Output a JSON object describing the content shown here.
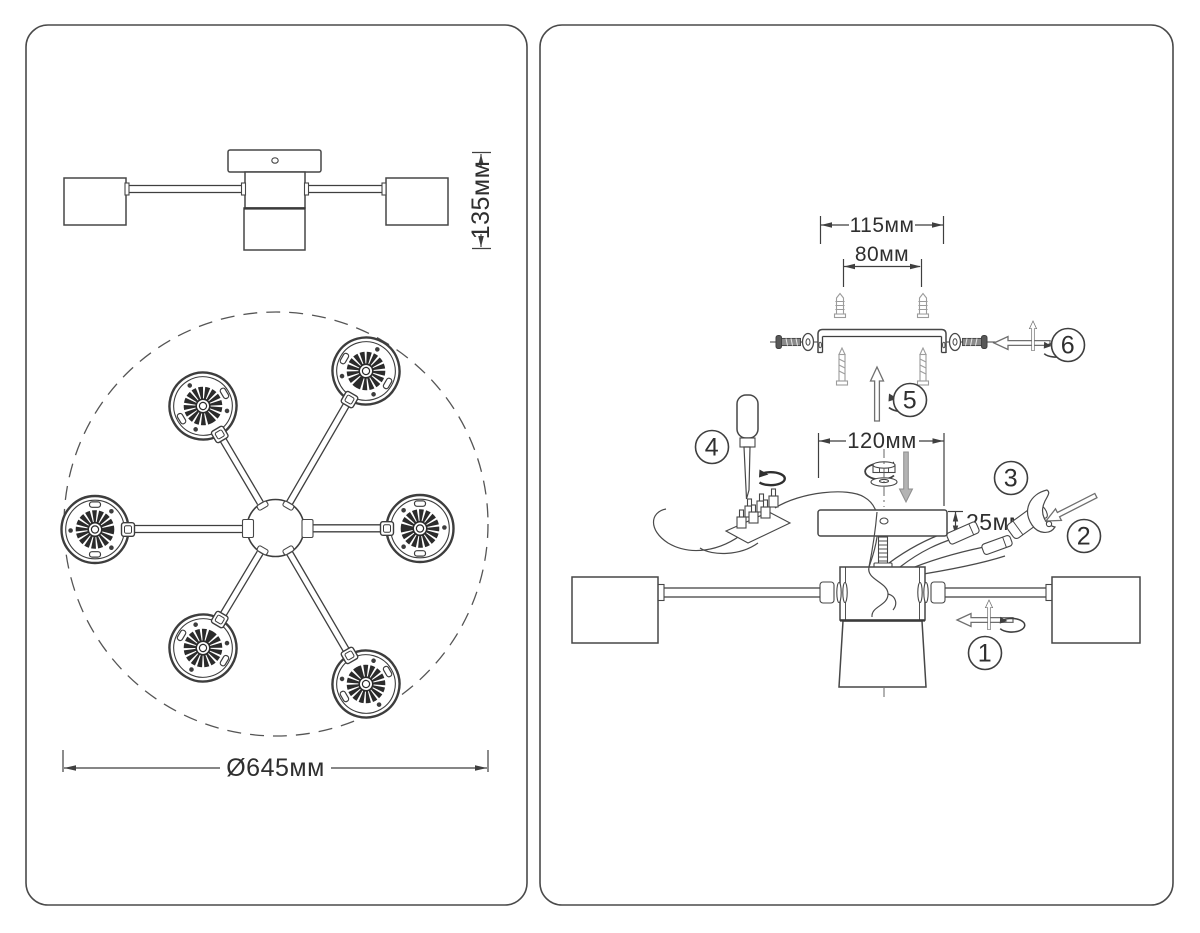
{
  "left_panel": {
    "side_view": {
      "height_label": "135мм"
    },
    "top_view": {
      "diameter_label": "Ø645мм"
    }
  },
  "right_panel": {
    "dim_bracket_width": "115мм",
    "dim_screw_spacing": "80мм",
    "dim_canopy_width": "120мм",
    "dim_canopy_height": "25мм",
    "steps": [
      {
        "number": "1"
      },
      {
        "number": "2"
      },
      {
        "number": "3"
      },
      {
        "number": "4"
      },
      {
        "number": "5"
      },
      {
        "number": "6"
      }
    ]
  },
  "colors": {
    "line": "#3f3f3f",
    "light_gray_part": "#9c9c9c",
    "background": "#ffffff"
  }
}
